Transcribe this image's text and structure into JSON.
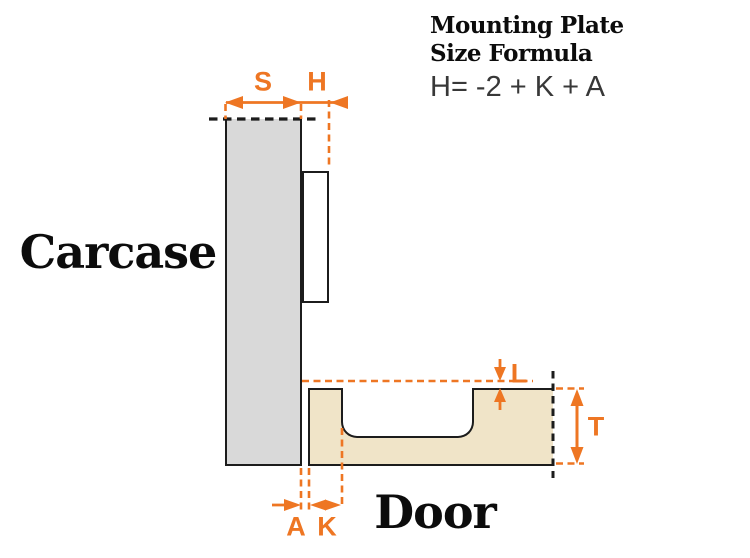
{
  "title": {
    "line1": "Mounting Plate",
    "line2": "Size Formula",
    "formula": "H= -2 + K + A"
  },
  "labels": {
    "carcase": "Carcase",
    "door": "Door"
  },
  "dimensions": {
    "s": "S",
    "h": "H",
    "l": "L",
    "t": "T",
    "a": "A",
    "k": "K"
  },
  "colors": {
    "accent_orange": "#ee7623",
    "carcase_fill": "#d9d9d9",
    "door_fill": "#f0e4c8",
    "outline_black": "#1c1c1c",
    "formula_text": "#383838"
  }
}
